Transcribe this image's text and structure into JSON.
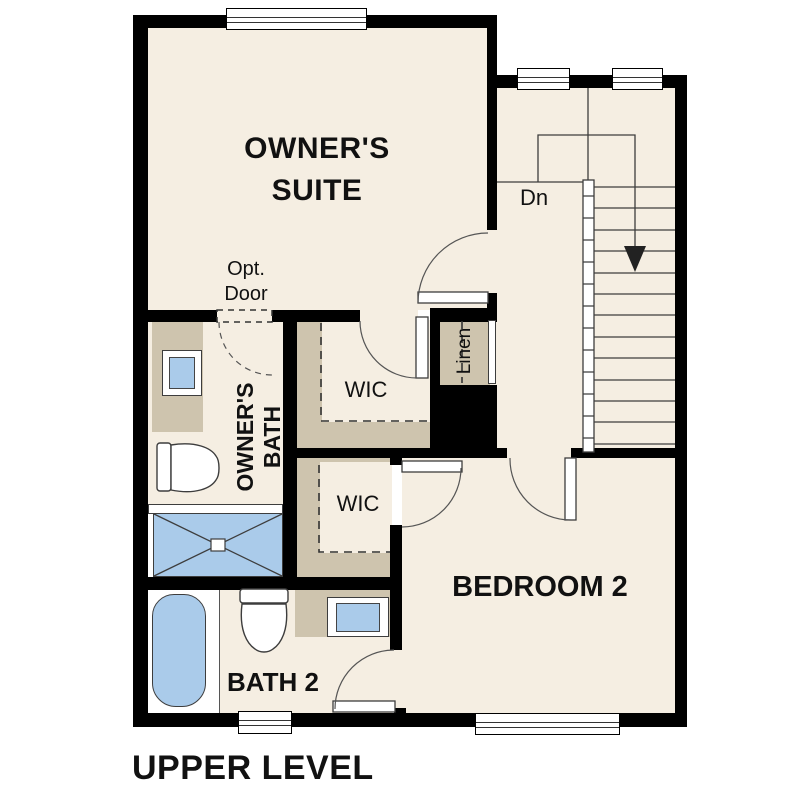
{
  "title": "UPPER LEVEL",
  "rooms": {
    "owners_suite": "OWNER'S SUITE",
    "owners_bath_line1": "OWNER'S",
    "owners_bath_line2": "BATH",
    "wic_upper": "WIC",
    "wic_lower": "WIC",
    "linen": "Linen",
    "bedroom2": "BEDROOM 2",
    "bath2": "BATH 2"
  },
  "annotations": {
    "stairs_down": "Dn",
    "optional_door_line1": "Opt.",
    "optional_door_line2": "Door"
  },
  "colors": {
    "floor": "#f5eee2",
    "shelf": "#cec4ae",
    "fixture": "#aacbea",
    "wall": "#000000",
    "line": "#3d3d3d",
    "text": "#111111",
    "paper": "#ffffff"
  }
}
